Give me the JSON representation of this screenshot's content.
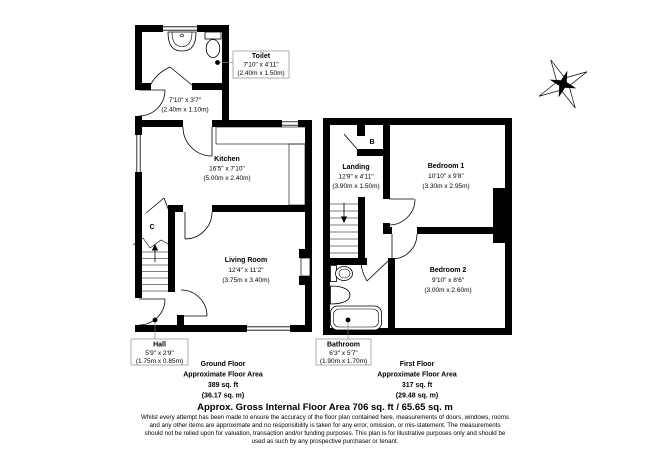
{
  "ground_floor": {
    "title": "Ground Floor",
    "subtitle": "Approximate Floor Area",
    "area_ft": "389 sq. ft",
    "area_m": "(36.17 sq. m)",
    "rooms": {
      "toilet": {
        "name": "Toilet",
        "size_imperial": "7'10\" x 4'11\"",
        "size_metric": "(2.40m x 1.50m)"
      },
      "lobby": {
        "size_imperial": "7'10\" x 3'7\"",
        "size_metric": "(2.40m x 1.10m)"
      },
      "kitchen": {
        "name": "Kitchen",
        "size_imperial": "16'5\" x 7'10\"",
        "size_metric": "(5.00m x 2.40m)"
      },
      "living_room": {
        "name": "Living Room",
        "size_imperial": "12'4\" x 11'2\"",
        "size_metric": "(3.75m x 3.40m)"
      },
      "hall": {
        "name": "Hall",
        "size_imperial": "5'9\" x 2'9\"",
        "size_metric": "(1.75m x 0.85m)"
      },
      "cupboard_label": "C"
    }
  },
  "first_floor": {
    "title": "First Floor",
    "subtitle": "Approximate Floor Area",
    "area_ft": "317 sq. ft",
    "area_m": "(29.48 sq. m)",
    "rooms": {
      "landing": {
        "name": "Landing",
        "size_imperial": "12'9\" x 4'11\"",
        "size_metric": "(3.90m x 1.50m)"
      },
      "bedroom1": {
        "name": "Bedroom 1",
        "size_imperial": "10'10\" x 9'8\"",
        "size_metric": "(3.30m x 2.95m)"
      },
      "bedroom2": {
        "name": "Bedroom 2",
        "size_imperial": "9'10\" x 8'6\"",
        "size_metric": "(3.00m x 2.60m)"
      },
      "bathroom": {
        "name": "Bathroom",
        "size_imperial": "6'3\" x 5'7\"",
        "size_metric": "(1.90m x 1.70m)"
      },
      "boiler_label": "B"
    }
  },
  "footer": {
    "title": "Approx. Gross Internal Floor Area 706 sq. ft / 65.65 sq. m",
    "disclaimer": "Whilst every attempt has been made to ensure the accuracy of the floor plan contained here, measurements of doors, windows, rooms and any other items are approximate and no responsibility is taken for any error, omission, or mis-statement. The measurements should not be relied upon for valuation, transaction and/or funding purposes. This plan is for illustrative purposes only and should be used as such by any prospective purchaser or tenant."
  }
}
